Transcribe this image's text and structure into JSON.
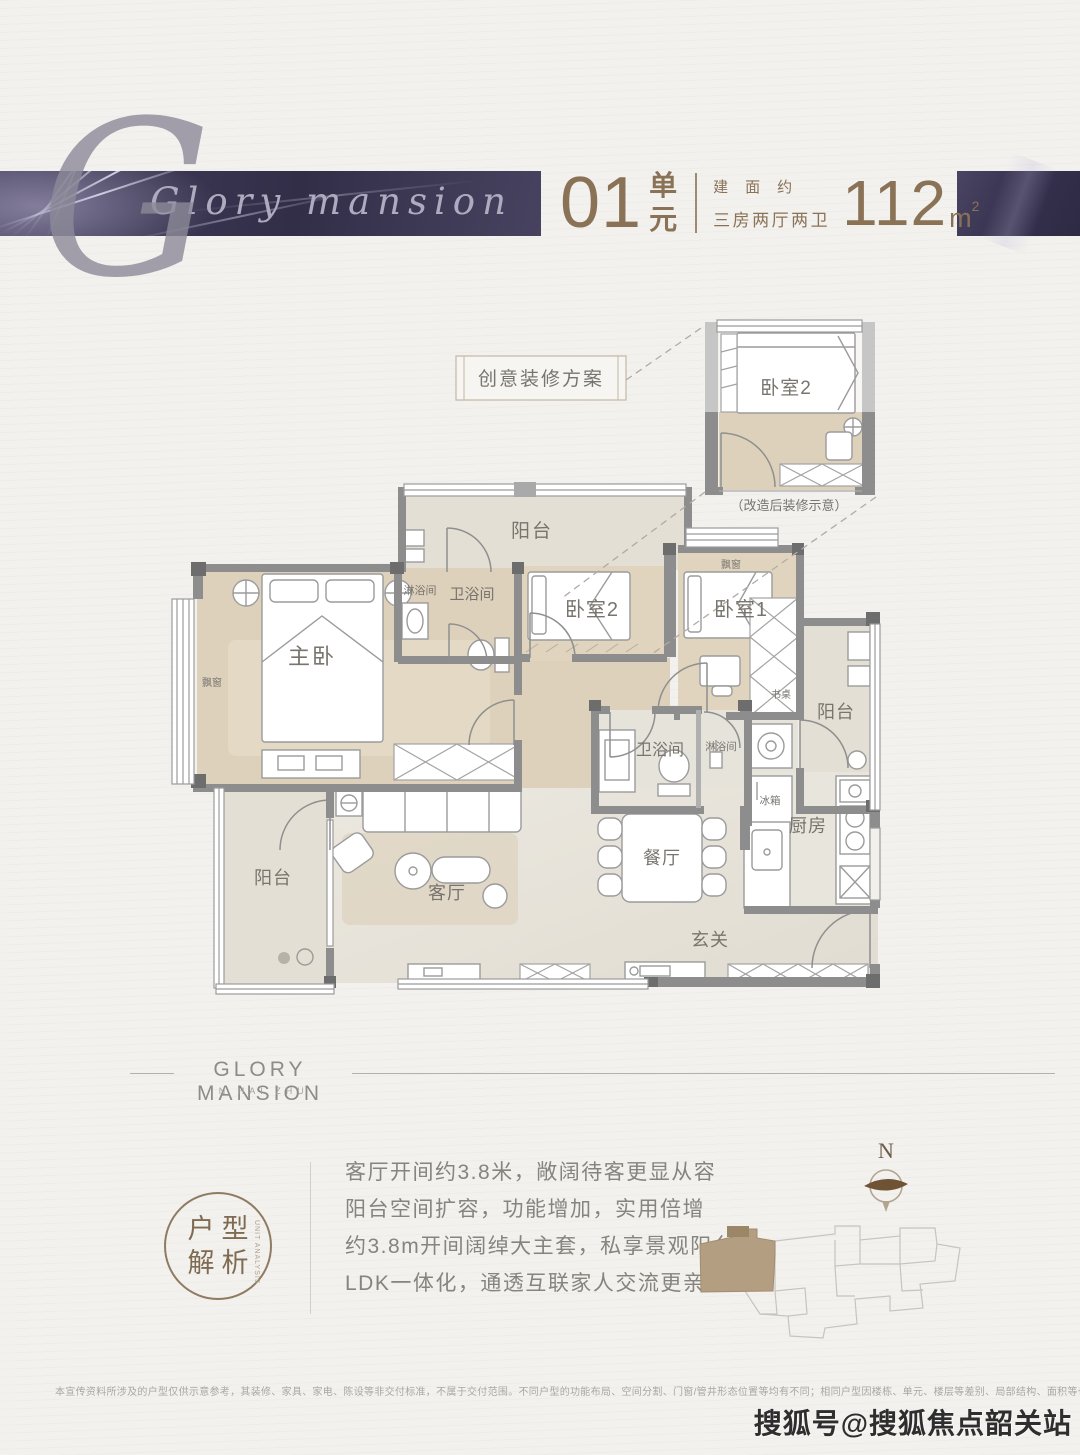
{
  "header": {
    "script_initial": "G",
    "script_brand": "Glory mansion",
    "unit_number": "01",
    "unit_label_top": "单",
    "unit_label_bottom": "元",
    "area_about": "建面约",
    "rooms_desc": "三房两厅两卫",
    "area_number": "112",
    "area_unit": "m",
    "area_sup": "2"
  },
  "floorplan": {
    "plan_title": "创意装修方案",
    "inset": {
      "room": "卧室2",
      "caption": "（改造后装修示意）"
    },
    "labels": {
      "balcony_top": "阳台",
      "shower_top": "淋浴间",
      "bath_top": "卫浴间",
      "bedroom2": "卧室2",
      "bedroom1": "卧室1",
      "baywindow_b1": "飘窗",
      "master": "主卧",
      "baywindow_master": "飘窗",
      "desk": "书桌",
      "balcony_right": "阳台",
      "bath_lower": "卫浴间",
      "shower_lower": "淋浴间",
      "fridge": "冰箱",
      "kitchen": "厨房",
      "dining": "餐厅",
      "living": "客厅",
      "foyer": "玄关",
      "balcony_bottom": "阳台"
    }
  },
  "brand": {
    "name": "GLORY MANSION",
    "sub": "IN HAI ZHU"
  },
  "analysis": {
    "badge_top": "户型",
    "badge_bottom": "解析",
    "badge_side": "UNIT ANALYSIS",
    "bullets": [
      "客厅开间约3.8米，敞阔待客更显从容",
      "阳台空间扩容，功能增加，实用倍增",
      "约3.8m开间阔绰大主套，私享景观阳台",
      "LDK一体化，通透互联家人交流更亲密"
    ]
  },
  "compass_label": "N",
  "disclaimer": "本宣传资料所涉及的户型仅供示意参考，其装修、家具、家电、陈设等非交付标准，不属于交付范围。不同户型的功能布局、空间分割、门窗/管井形态位置等均有不同；相同户型因楼栋、单元、楼层等差别、局部结构、面积等也可能不同，具体以双方签订的商品房买卖合同约定为准。",
  "watermark": "搜狐号@搜狐焦点韶关站",
  "colors": {
    "banner": "#3a3652",
    "accent_brown": "#8a7257",
    "wall_gray": "#8d8d8d",
    "wood_floor": "#ded2bc",
    "tile_floor": "#e9e6de",
    "highlight_building": "#b49e82"
  }
}
